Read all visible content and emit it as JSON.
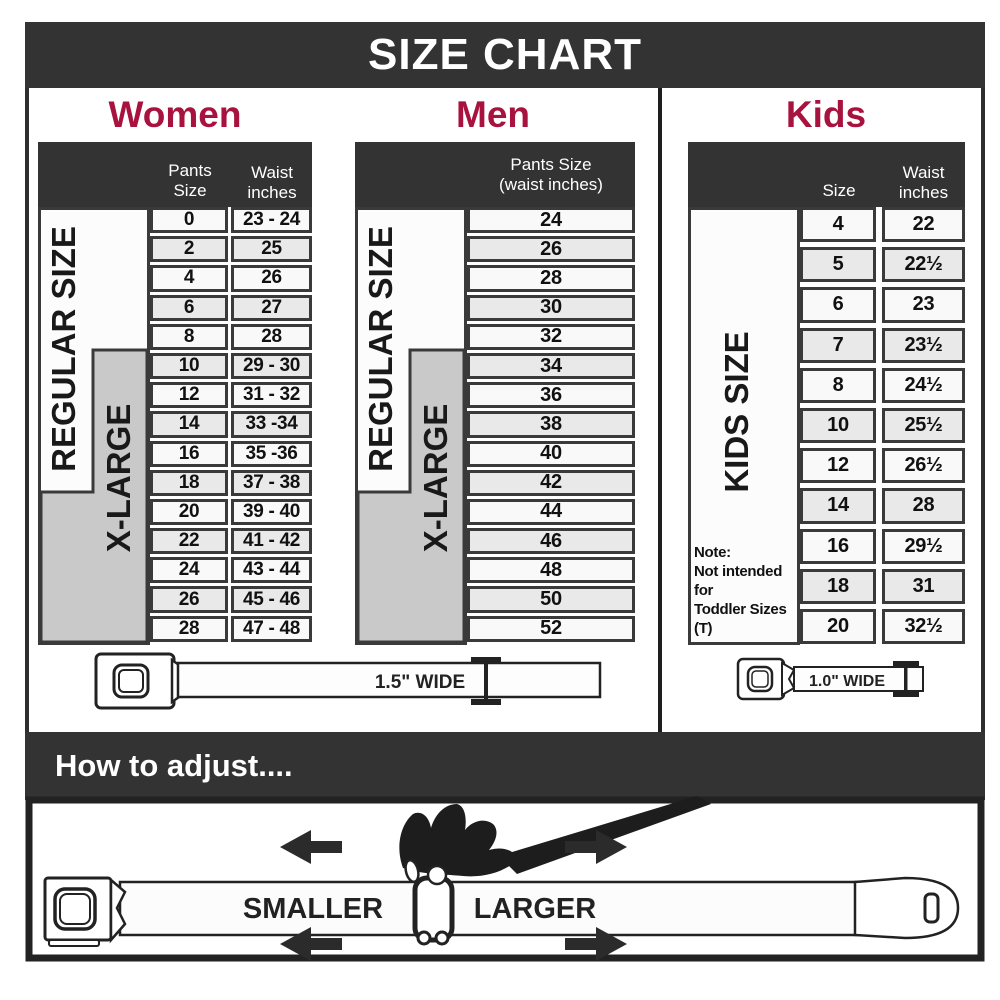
{
  "title": "SIZE CHART",
  "colors": {
    "dark": "#333333",
    "accent": "#a8123e",
    "gray_box": "#c9c9c9",
    "row_light": "#f9f9f9",
    "row_alt": "#e9e9e9",
    "cell_border": "#3a3a3a"
  },
  "women": {
    "heading": "Women",
    "col1_header": "Pants Size",
    "col2_header_line1": "Waist",
    "col2_header_line2": "inches",
    "regular_label": "REGULAR SIZE",
    "xlarge_label": "X-LARGE",
    "rows": [
      {
        "size": "0",
        "waist": "23 - 24"
      },
      {
        "size": "2",
        "waist": "25"
      },
      {
        "size": "4",
        "waist": "26"
      },
      {
        "size": "6",
        "waist": "27"
      },
      {
        "size": "8",
        "waist": "28"
      },
      {
        "size": "10",
        "waist": "29 - 30"
      },
      {
        "size": "12",
        "waist": "31 - 32"
      },
      {
        "size": "14",
        "waist": "33 -34"
      },
      {
        "size": "16",
        "waist": "35 -36"
      },
      {
        "size": "18",
        "waist": "37 - 38"
      },
      {
        "size": "20",
        "waist": "39 - 40"
      },
      {
        "size": "22",
        "waist": "41 - 42"
      },
      {
        "size": "24",
        "waist": "43 - 44"
      },
      {
        "size": "26",
        "waist": "45 - 46"
      },
      {
        "size": "28",
        "waist": "47 - 48"
      }
    ]
  },
  "men": {
    "heading": "Men",
    "header_line1": "Pants Size",
    "header_line2": "(waist inches)",
    "regular_label": "REGULAR SIZE",
    "xlarge_label": "X-LARGE",
    "rows": [
      "24",
      "26",
      "28",
      "30",
      "32",
      "34",
      "36",
      "38",
      "40",
      "42",
      "44",
      "46",
      "48",
      "50",
      "52"
    ]
  },
  "kids": {
    "heading": "Kids",
    "col1_header": "Size",
    "col2_header_line1": "Waist",
    "col2_header_line2": "inches",
    "side_label": "KIDS SIZE",
    "note_line1": "Note:",
    "note_line2": "Not intended for",
    "note_line3": "Toddler Sizes (T)",
    "rows": [
      {
        "size": "4",
        "waist": "22"
      },
      {
        "size": "5",
        "waist": "22½"
      },
      {
        "size": "6",
        "waist": "23"
      },
      {
        "size": "7",
        "waist": "23½"
      },
      {
        "size": "8",
        "waist": "24½"
      },
      {
        "size": "10",
        "waist": "25½"
      },
      {
        "size": "12",
        "waist": "26½"
      },
      {
        "size": "14",
        "waist": "28"
      },
      {
        "size": "16",
        "waist": "29½"
      },
      {
        "size": "18",
        "waist": "31"
      },
      {
        "size": "20",
        "waist": "32½"
      }
    ]
  },
  "belts": {
    "adult_width_label": "1.5\" WIDE",
    "kids_width_label": "1.0\" WIDE"
  },
  "adjust": {
    "heading": "How to adjust....",
    "smaller_label": "SMALLER",
    "larger_label": "LARGER"
  }
}
